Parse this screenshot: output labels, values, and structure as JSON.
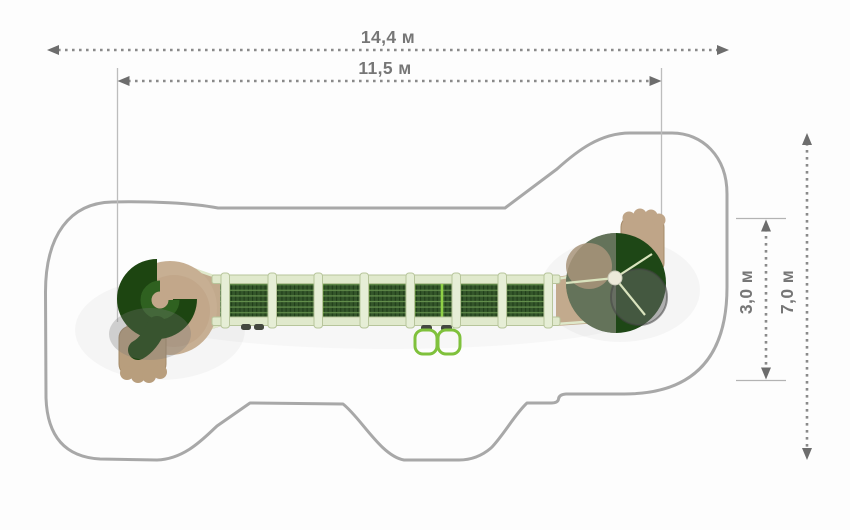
{
  "dimensions": {
    "total_length": {
      "label": "14,4 м"
    },
    "equipment_length": {
      "label": "11,5 м"
    },
    "total_width": {
      "label": "7,0 м"
    },
    "equipment_zone_width": {
      "label": "3,0 м"
    }
  },
  "colors": {
    "dimension_gray": "#767676",
    "safety_zone_outline": "#a8a8a8",
    "slide_dark_green": "#1d4511",
    "net_dark_green": "#33552a",
    "lime_accent": "#8fd046",
    "frame_sage": "#e0e9cc",
    "wood_tan": "#c2aa8d",
    "dome_gray": "#8b8b85"
  }
}
